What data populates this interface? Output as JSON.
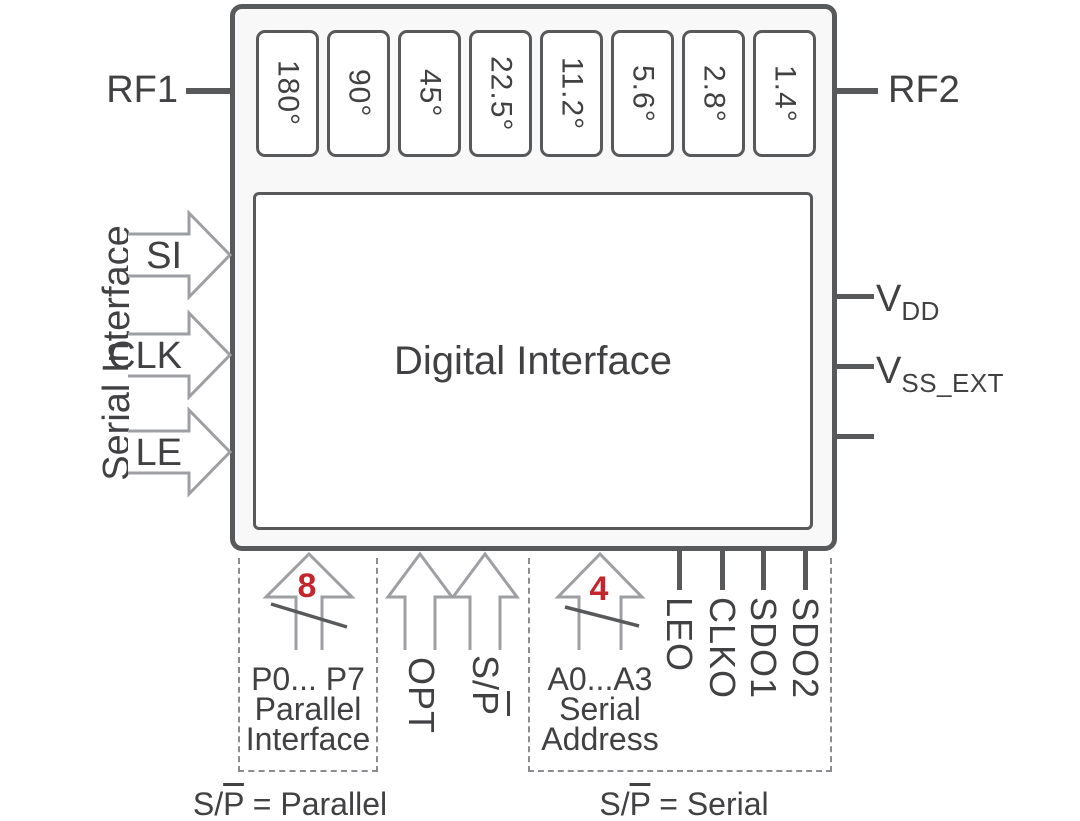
{
  "ports": {
    "rf1": "RF1",
    "rf2": "RF2",
    "serial_interface_group": "Serial Interface",
    "si": "SI",
    "clk": "CLK",
    "le": "LE",
    "vdd_base": "V",
    "vdd_sub": "DD",
    "vss_base": "V",
    "vss_sub": "SS_EXT"
  },
  "chip": {
    "phase_bits": [
      "180°",
      "90°",
      "45°",
      "22.5°",
      "11.2°",
      "5.6°",
      "2.8°",
      "1.4°"
    ],
    "digital_interface": "Digital Interface"
  },
  "bottom": {
    "parallel": {
      "bus_width": "8",
      "pins": "P0... P7",
      "caption1": "Parallel",
      "caption2": "Interface"
    },
    "opt": "OPT",
    "sp_prefix": "S/",
    "sp_overline": "P",
    "serial": {
      "bus_width": "4",
      "pins": "A0...A3",
      "caption1": "Serial",
      "caption2": "Address"
    },
    "outputs": [
      "LEO",
      "CLKO",
      "SDO1",
      "SDO2"
    ]
  },
  "notes": {
    "parallel_prefix": "S/",
    "parallel_overline": "P",
    "parallel_rest": " = Parallel",
    "serial_prefix": "S/",
    "serial_overline": "P",
    "serial_rest": " = Serial"
  },
  "colors": {
    "outline_dark": "#58595B",
    "arrow_gray": "#9D9FA2",
    "text": "#414042",
    "accent_red": "#C4262E",
    "dashed_gray": "#8A8C8F"
  }
}
